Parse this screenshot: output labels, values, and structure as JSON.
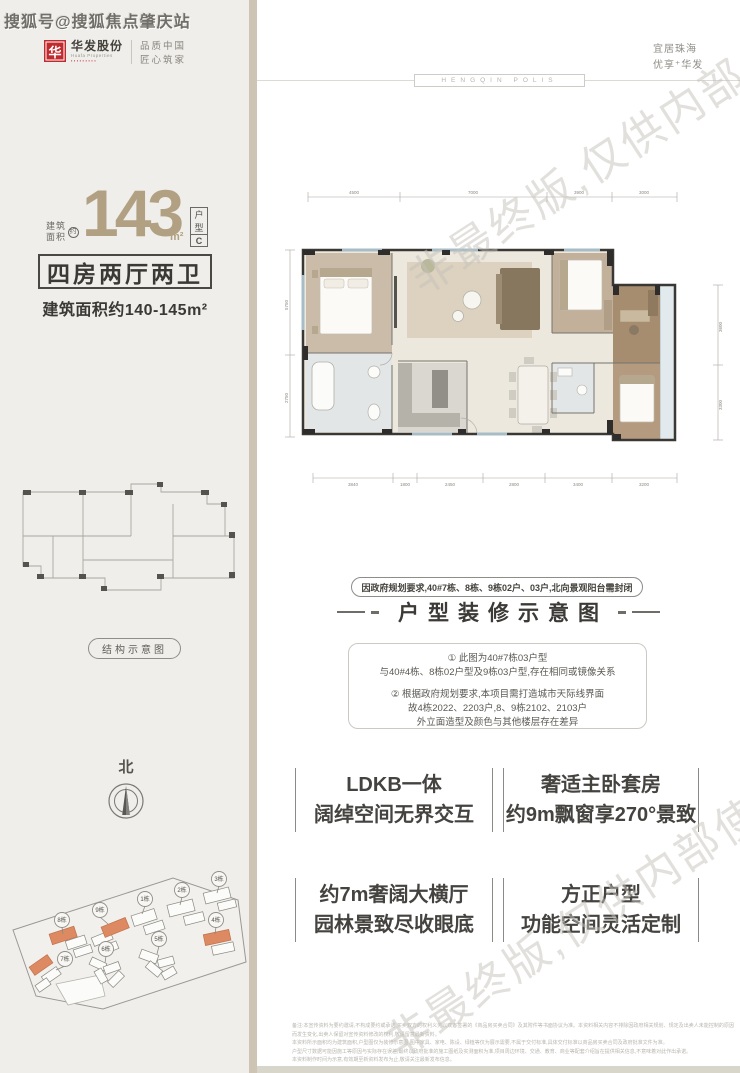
{
  "watermarks": {
    "sohu": "搜狐号@搜狐焦点肇庆站",
    "diagonal": "非最终版,仅供内部使用"
  },
  "brand": {
    "logo_glyph": "华",
    "logo_name": "华发股份",
    "logo_sub": "Huafa Properties",
    "logo_dots": "▪▪▪▪▪▪▪▪▪",
    "tagline1": "品质中国",
    "tagline2": "匠心筑家"
  },
  "slogan": {
    "line1": "宜居珠海",
    "line2": "优享⁺华发",
    "divider_badge": "HENGQIN POLIS"
  },
  "unit": {
    "area_label1": "建筑",
    "area_label2": "面积",
    "approx": "约",
    "area_value": "143",
    "area_unit": "m²",
    "type_chars": [
      "户",
      "型",
      "C"
    ],
    "rooms": "四房两厅两卫",
    "area_range": "建筑面积约140-145m²"
  },
  "structure_label": "结构示意图",
  "compass_north": "北",
  "siteplan": {
    "buildings": [
      {
        "label": "1栋"
      },
      {
        "label": "2栋"
      },
      {
        "label": "3栋"
      },
      {
        "label": "4栋"
      },
      {
        "label": "5栋"
      },
      {
        "label": "6栋"
      },
      {
        "label": "7栋"
      },
      {
        "label": "8栋"
      },
      {
        "label": "9栋"
      }
    ]
  },
  "floorplan": {
    "dims_top": [
      "4500",
      "7000",
      "3900",
      "3000"
    ],
    "dims_bottom": [
      "3840",
      "1800",
      "2450",
      "2800",
      "3400",
      "3200"
    ],
    "dims_left": [
      "5750",
      "2750"
    ],
    "dims_right": [
      "3600",
      "3300"
    ]
  },
  "notice_pill": "因政府规划要求,40#7栋、8栋、9栋02户、03户,北向景观阳台需封闭",
  "section_heading": "户型装修示意图",
  "notes": {
    "l1": "① 此图为40#7栋03户型",
    "l2": "与40#4栋、8栋02户型及9栋03户型,存在相同或镜像关系",
    "l3": "② 根据政府规划要求,本项目需打造城市天际线界面",
    "l4": "故4栋2022、2203户,8、9栋2102、2103户",
    "l5": "外立面造型及颜色与其他楼层存在差异"
  },
  "features": [
    {
      "line1": "LDKB一体",
      "line2": "阔绰空间无界交互"
    },
    {
      "line1": "奢适主卧套房",
      "line2": "约9m飘窗享270°景致"
    },
    {
      "line1": "约7m奢阔大横厅",
      "line2": "园林景致尽收眼底"
    },
    {
      "line1": "方正户型",
      "line2": "功能空间灵活定制"
    }
  ],
  "disclaimer": {
    "l1": "备注:本宣传资料为要约邀请,不构成要约或承诺,买卖双方的权利义务以双方签署的《商品房买卖合同》及其附件等书面协议为准。本资料相关内容不排除因政府相关规划、规定及出卖人未能控制的原因而发生变化,出卖人保留对宣传资料修改的权利,敬请留意最新资料。",
    "l2": "本资料所示面积均为建筑面积,户型图仅为装修示意图,图中家具、家电、陈设、绿植等仅为展示需要,不属于交付标准,具体交付标准以商品房买卖合同及政府批准文件为准。",
    "l3": "户型尺寸数据可能因施工等原因与实际存在误差,最终以政府批准的施工图纸及实测面积为准,项目周边环境、交通、教育、商业等配套介绍旨在提供相关信息,不意味着对此作出承诺。",
    "l4": "本资料制作时间为示意,有效期至新资料发布为止,敬请关注最新发布信息。"
  }
}
